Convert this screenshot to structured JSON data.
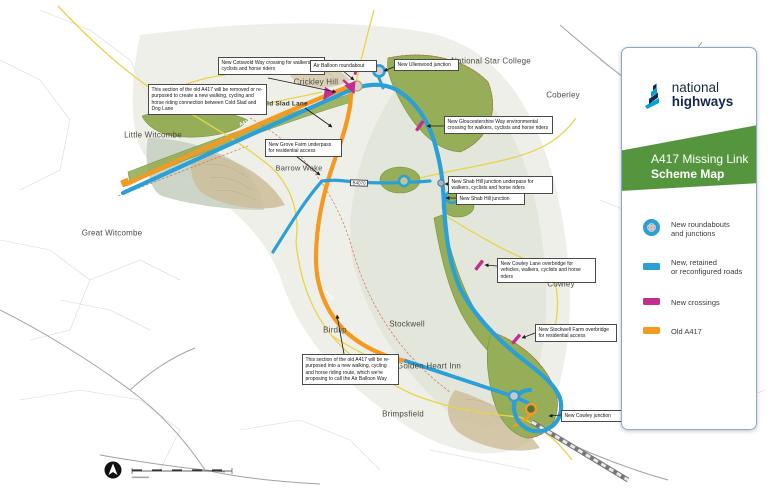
{
  "panel": {
    "brand": {
      "line1": "national",
      "line2": "highways"
    },
    "title_line1": "A417 Missing Link",
    "title_line2": "Scheme Map",
    "legend": [
      {
        "line1": "New roundabouts",
        "line2": "and junctions"
      },
      {
        "line1": "New, retained",
        "line2": "or reconfigured roads"
      },
      {
        "line1": "New crossings",
        "line2": ""
      },
      {
        "line1": "Old A417",
        "line2": ""
      }
    ],
    "colors": {
      "new_road": "#2B9FD8",
      "crossing": "#C42E90",
      "old_road": "#F49A21",
      "banner_green": "#55953D",
      "brand_navy": "#13294B",
      "brand_cyan": "#00A0DD"
    }
  },
  "map": {
    "places": [
      {
        "name": "Little Witcombe"
      },
      {
        "name": "Great Witcombe"
      },
      {
        "name": "Crickley Hill"
      },
      {
        "name": "Cold Slad Lane"
      },
      {
        "name": "Barrow Wake"
      },
      {
        "name": "National Star College"
      },
      {
        "name": "Coberley"
      },
      {
        "name": "Cowley"
      },
      {
        "name": "Birdlip"
      },
      {
        "name": "Stockwell"
      },
      {
        "name": "Golden Heart Inn"
      },
      {
        "name": "Brimpsfield"
      }
    ],
    "road_labels": [
      {
        "text": "A417"
      },
      {
        "text": "A417"
      },
      {
        "text": "B4070"
      }
    ],
    "callouts": [
      {
        "text": "New Cotswold Way crossing for walkers, cyclists and horse riders"
      },
      {
        "text": "This section of the old A417 will be removed or re-purposed to create a new walking, cycling and horse riding connection between Cold Slad and Dog Lane"
      },
      {
        "text": "Air Balloon roundabout"
      },
      {
        "text": "New Ullenwood junction"
      },
      {
        "text": "New Gloucestershire Way environmental crossing for walkers, cyclists and horse riders"
      },
      {
        "text": "New Shab Hill junction underpass for walkers, cyclists and horse riders"
      },
      {
        "text": "New Shab Hill junction"
      },
      {
        "text": "New Grove Farm underpass for residential access"
      },
      {
        "text": "New Cowley Lane overbridge for vehicles, walkers, cyclists and horse riders"
      },
      {
        "text": "New Stockwell Farm overbridge for residential access"
      },
      {
        "text": "This section of the old A417 will be re-purposed into a new walking, cycling and horse riding route, which we're proposing to call the Air Balloon Way"
      },
      {
        "text": "New Cowley junction"
      }
    ]
  }
}
